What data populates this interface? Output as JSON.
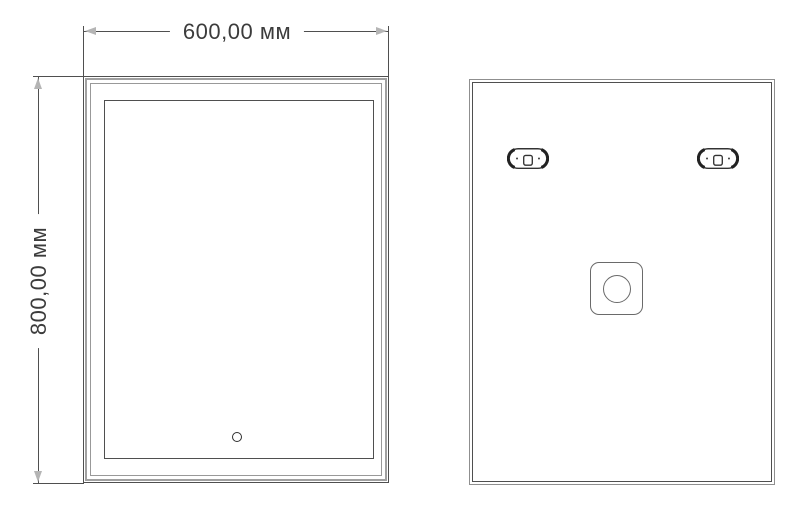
{
  "drawing": {
    "type": "technical-drawing",
    "subject": "rectangular mirror, front and back views",
    "dimensions": {
      "width": {
        "value": "600,00 мм"
      },
      "height": {
        "value": "800,00 мм"
      }
    },
    "views": {
      "front": {
        "name": "front view",
        "features": [
          "outer frame",
          "inner illuminated edge",
          "touch sensor circle"
        ]
      },
      "back": {
        "name": "back view",
        "features": [
          "mounting bracket left",
          "mounting bracket right",
          "junction box with round knockout"
        ]
      }
    },
    "colors": {
      "line_dark": "#4f4f4f",
      "line_mid": "#8f8f8f",
      "frame_gray": "#a0a0a0",
      "arrow_gray": "#b5b5b5",
      "text_color": "#3c3c3c",
      "background": "#ffffff"
    }
  }
}
